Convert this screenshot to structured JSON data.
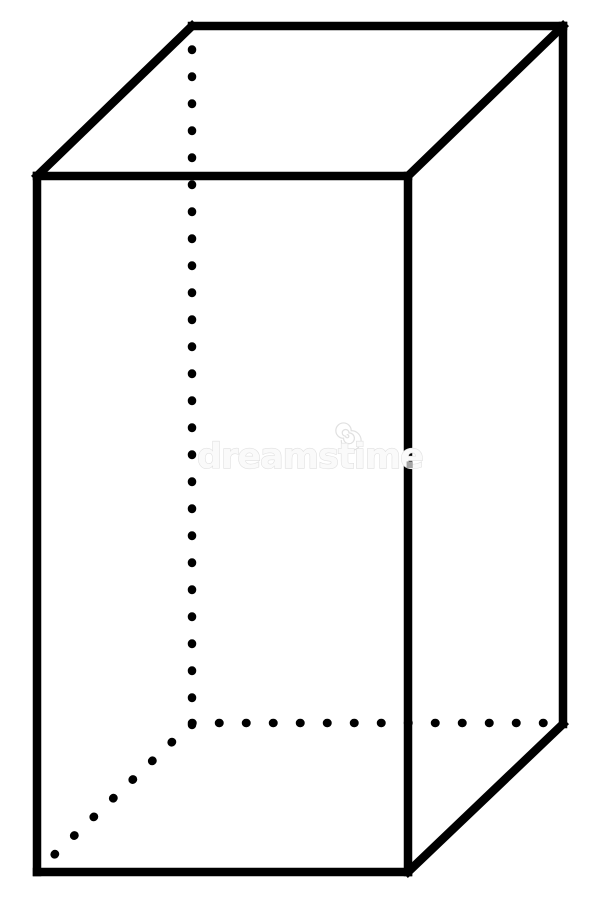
{
  "page": {
    "background": "#ffffff",
    "width": 600,
    "height": 900,
    "description": "Black and white line drawing of a rectangular prism (cuboid) with hidden edges shown as dotted lines"
  },
  "figure": {
    "name": "rectangular-prism",
    "stroke_color": "#000000",
    "stroke_width": 8.5,
    "dot_length": 0.5,
    "dot_gap": 26.5,
    "solid_edges": [
      {
        "name": "edge-back-top",
        "x1": 192,
        "y1": 26,
        "x2": 563,
        "y2": 26
      },
      {
        "name": "edge-front-top",
        "x1": 37,
        "y1": 176,
        "x2": 408,
        "y2": 176
      },
      {
        "name": "edge-top-left-diagonal",
        "x1": 37,
        "y1": 176,
        "x2": 192,
        "y2": 26
      },
      {
        "name": "edge-top-right-diagonal",
        "x1": 408,
        "y1": 176,
        "x2": 563,
        "y2": 26
      },
      {
        "name": "edge-front-left-vertical",
        "x1": 37,
        "y1": 176,
        "x2": 37,
        "y2": 872
      },
      {
        "name": "edge-front-right-vertical",
        "x1": 408,
        "y1": 176,
        "x2": 408,
        "y2": 872
      },
      {
        "name": "edge-back-right-vertical",
        "x1": 563,
        "y1": 26,
        "x2": 563,
        "y2": 724
      },
      {
        "name": "edge-front-bottom",
        "x1": 37,
        "y1": 872,
        "x2": 408,
        "y2": 872
      },
      {
        "name": "edge-bottom-right-diagonal",
        "x1": 408,
        "y1": 872,
        "x2": 563,
        "y2": 724
      }
    ],
    "hidden_edges": [
      {
        "name": "edge-back-left-vertical-hidden",
        "x1": 192,
        "y1": 725,
        "x2": 192,
        "y2": 48
      },
      {
        "name": "edge-back-bottom-hidden",
        "x1": 192,
        "y1": 723,
        "x2": 548,
        "y2": 723
      },
      {
        "name": "edge-bottom-left-diagonal-hidden",
        "x1": 172,
        "y1": 742,
        "x2": 54,
        "y2": 855
      }
    ]
  },
  "watermark": {
    "text": "dreamstime",
    "period": ".",
    "fill_color": "#fafafa",
    "outline_color": "#e0e0e0",
    "period_color": "#a3a3a3"
  }
}
